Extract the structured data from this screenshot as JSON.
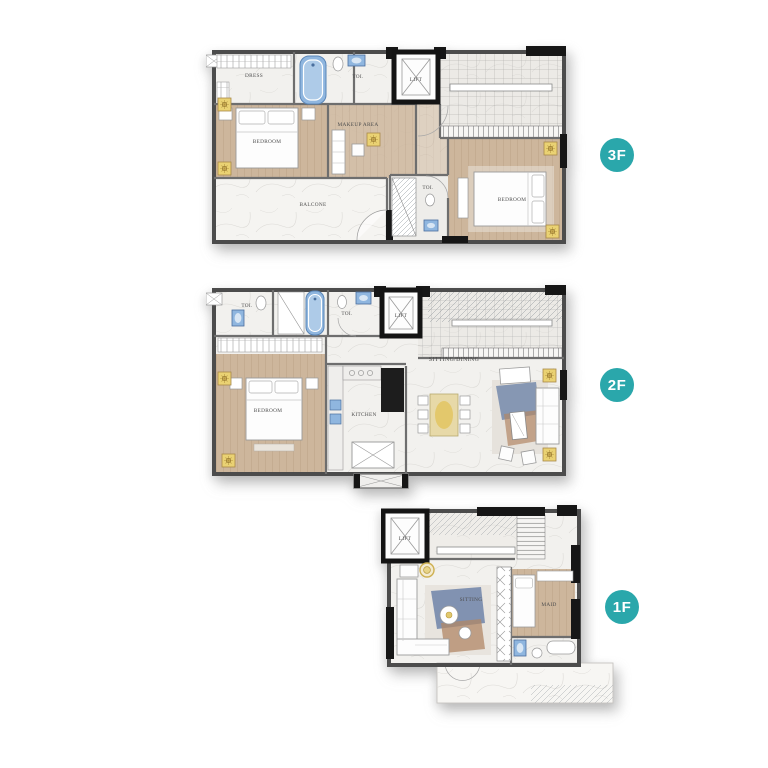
{
  "page": {
    "background": "#ffffff"
  },
  "badge": {
    "color": "#2aa7ab",
    "text_color": "#ffffff"
  },
  "palette": {
    "wall": "#4c4c4c",
    "wall_dark": "#161616",
    "interior_wall": "#6e6e6e",
    "marble_floor": "#f2f1ee",
    "wood_floor": "#cdb69c",
    "fixture_blue": "#8fb6df",
    "accent_yellow": "#ead273",
    "rug_blue": "#6e84a9",
    "rug_brown": "#b28765"
  },
  "floors": [
    {
      "id": "3f",
      "badge_label": "3F",
      "rooms": {
        "dress": "DRESS",
        "toi_top": "TOI.",
        "lift": "LIFT",
        "bedroom_left": "BEDROOM",
        "makeup_area": "MAKEUP AREA",
        "balcone": "BALCONE",
        "toi_bottom": "TOI.",
        "bedroom_right": "BEDROOM"
      }
    },
    {
      "id": "2f",
      "badge_label": "2F",
      "rooms": {
        "toi_left": "TOI.",
        "toi_right": "TOI.",
        "lift": "LIFT",
        "bedroom": "BEDROOM",
        "kitchen": "KITCHEN",
        "sitting_dining": "SITTING/DINING"
      }
    },
    {
      "id": "1f",
      "badge_label": "1F",
      "rooms": {
        "lift": "LIFT",
        "sitting": "SITTING",
        "maid": "MAID"
      }
    }
  ]
}
